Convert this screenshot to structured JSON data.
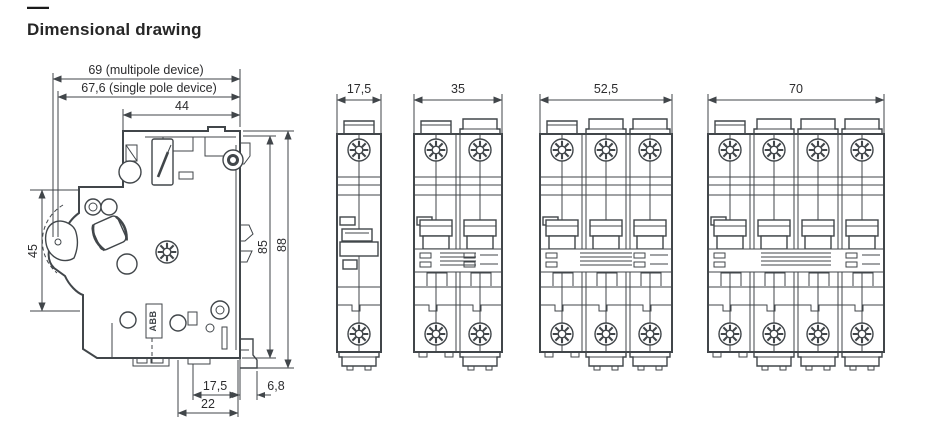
{
  "header": {
    "dash": "—",
    "title": "Dimensional drawing"
  },
  "colors": {
    "abb_red": "#e51f23",
    "line": "#41464a"
  },
  "side_view": {
    "brand": "ABB",
    "dimensions": {
      "multipole_width": "69 (multipole device)",
      "single_pole_width": "67,6 (single pole device)",
      "top_width": "44",
      "handle_height": "45",
      "body_height": "85",
      "total_height": "88",
      "bottom_depth": "17,5",
      "rail_offset": "6,8",
      "base_depth": "22"
    }
  },
  "front_views": [
    {
      "poles": 1,
      "width_label": "17,5",
      "brand": "ABB"
    },
    {
      "poles": 2,
      "width_label": "35",
      "brand": "ABB"
    },
    {
      "poles": 3,
      "width_label": "52,5",
      "brand": "ABB"
    },
    {
      "poles": 4,
      "width_label": "70",
      "brand": "ABB"
    }
  ]
}
